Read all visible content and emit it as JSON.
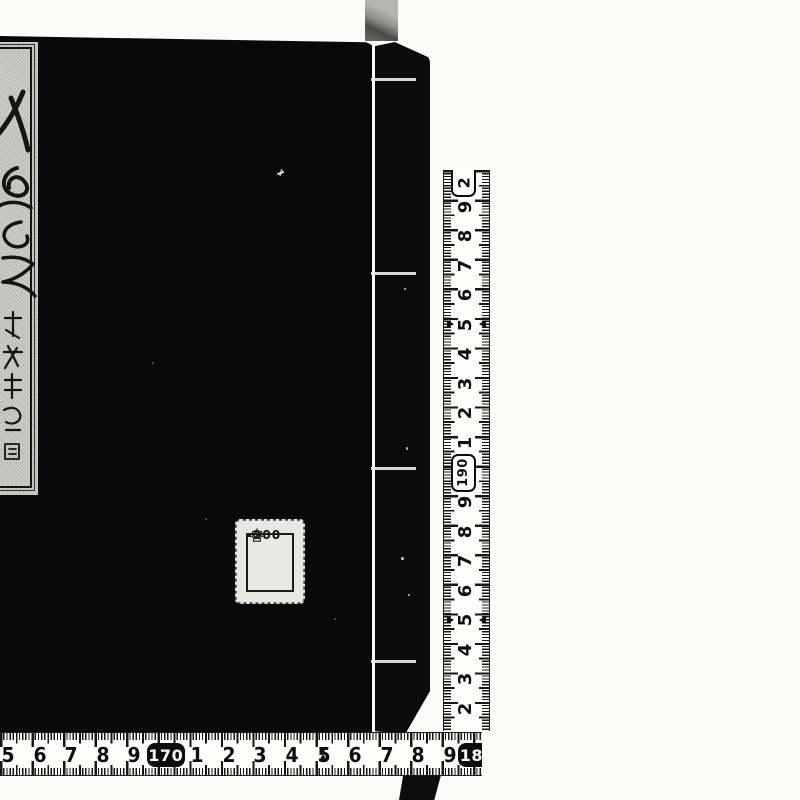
{
  "scene": {
    "description": "Photograph of a black stab-bound Japanese book with a calligraphy title slip, a small price sticker, and two centimeter measuring tapes along the right and bottom edges"
  },
  "colors": {
    "background": "#fbfbfa",
    "book_cover": "#090909",
    "tape_white": "#fdfdfc",
    "tape_ink": "#0e0e0e",
    "label_paper": "#c7c7c1",
    "sticker_paper": "#e8e8e2"
  },
  "title_label": {
    "main_text_description": "large cursive kanji title, partially cut off at left image edge",
    "signature_text_description": "small cursive kanji signature column, illegible"
  },
  "price_sticker": {
    "rows": [
      {
        "glyph": "he-katakana",
        "glyph_text": "ヘ",
        "value": "300"
      },
      {
        "glyph": "",
        "glyph_text": "",
        "value": ""
      },
      {
        "glyph": "miya-kanji",
        "glyph_text": "宮",
        "value": "200"
      }
    ]
  },
  "vertical_ruler": {
    "unit": "cm",
    "range_cm": [
      182,
      200
    ],
    "arrow_cm": [
      185,
      195
    ],
    "marks": [
      {
        "cm": 200,
        "label": "200",
        "visible": "2",
        "style": "open-box"
      },
      {
        "cm": 199,
        "label": "9"
      },
      {
        "cm": 198,
        "label": "8"
      },
      {
        "cm": 197,
        "label": "7"
      },
      {
        "cm": 196,
        "label": "6"
      },
      {
        "cm": 195,
        "label": "5"
      },
      {
        "cm": 194,
        "label": "4"
      },
      {
        "cm": 193,
        "label": "3"
      },
      {
        "cm": 192,
        "label": "2"
      },
      {
        "cm": 191,
        "label": "1"
      },
      {
        "cm": 190,
        "label": "190",
        "style": "outlined-box"
      },
      {
        "cm": 189,
        "label": "9"
      },
      {
        "cm": 188,
        "label": "8"
      },
      {
        "cm": 187,
        "label": "7"
      },
      {
        "cm": 186,
        "label": "6"
      },
      {
        "cm": 185,
        "label": "5"
      },
      {
        "cm": 184,
        "label": "4"
      },
      {
        "cm": 183,
        "label": "3"
      },
      {
        "cm": 182,
        "label": "2"
      }
    ]
  },
  "horizontal_ruler": {
    "unit": "cm",
    "range_cm": [
      165,
      180
    ],
    "arrow_cm": [
      175
    ],
    "marks": [
      {
        "cm": 165,
        "label": "5"
      },
      {
        "cm": 166,
        "label": "6"
      },
      {
        "cm": 167,
        "label": "7"
      },
      {
        "cm": 168,
        "label": "8"
      },
      {
        "cm": 169,
        "label": "9"
      },
      {
        "cm": 170,
        "label": "170",
        "style": "filled-box"
      },
      {
        "cm": 171,
        "label": "1"
      },
      {
        "cm": 172,
        "label": "2"
      },
      {
        "cm": 173,
        "label": "3"
      },
      {
        "cm": 174,
        "label": "4"
      },
      {
        "cm": 175,
        "label": "5"
      },
      {
        "cm": 176,
        "label": "6"
      },
      {
        "cm": 177,
        "label": "7"
      },
      {
        "cm": 178,
        "label": "8"
      },
      {
        "cm": 179,
        "label": "9"
      },
      {
        "cm": 180,
        "label": "180",
        "style": "filled-box",
        "clipped": true
      }
    ]
  }
}
